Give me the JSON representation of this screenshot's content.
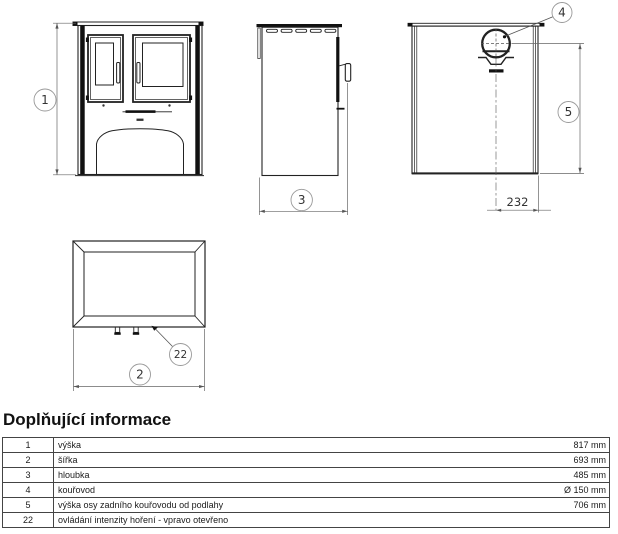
{
  "drawing": {
    "callout_height": "1",
    "callout_width": "2",
    "callout_depth": "3",
    "callout_flue": "4",
    "callout_flue_height": "5",
    "callout_control": "22",
    "dim_flue_offset": "232"
  },
  "info": {
    "title": "Doplňující informace",
    "rows": [
      {
        "num": "1",
        "label": "výška",
        "value": "817 mm"
      },
      {
        "num": "2",
        "label": "šířka",
        "value": "693 mm"
      },
      {
        "num": "3",
        "label": "hloubka",
        "value": "485 mm"
      },
      {
        "num": "4",
        "label": "kouřovod",
        "value": "Ø 150 mm"
      },
      {
        "num": "5",
        "label": "výška osy zadního kouřovodu od podlahy",
        "value": "706 mm"
      },
      {
        "num": "22",
        "label": "ovládání intenzity hoření - vpravo otevřeno",
        "value": ""
      }
    ]
  }
}
